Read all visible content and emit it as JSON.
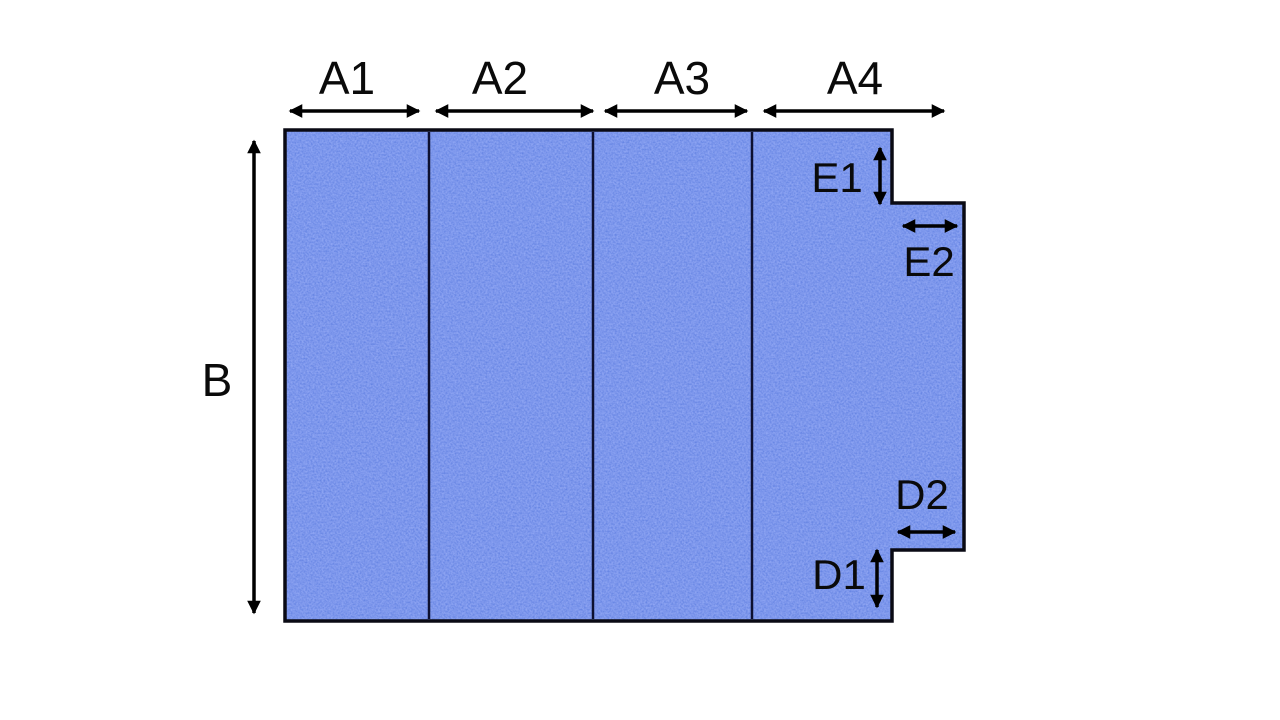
{
  "diagram": {
    "labels": {
      "a1": "A1",
      "a2": "A2",
      "a3": "A3",
      "a4": "A4",
      "b": "B",
      "e1": "E1",
      "e2": "E2",
      "d1": "D1",
      "d2": "D2"
    },
    "colors": {
      "panel_fill": "#3e5cdc",
      "outline": "#0a0a14",
      "dimension_lines": "#000000",
      "background": "#ffffff"
    }
  }
}
